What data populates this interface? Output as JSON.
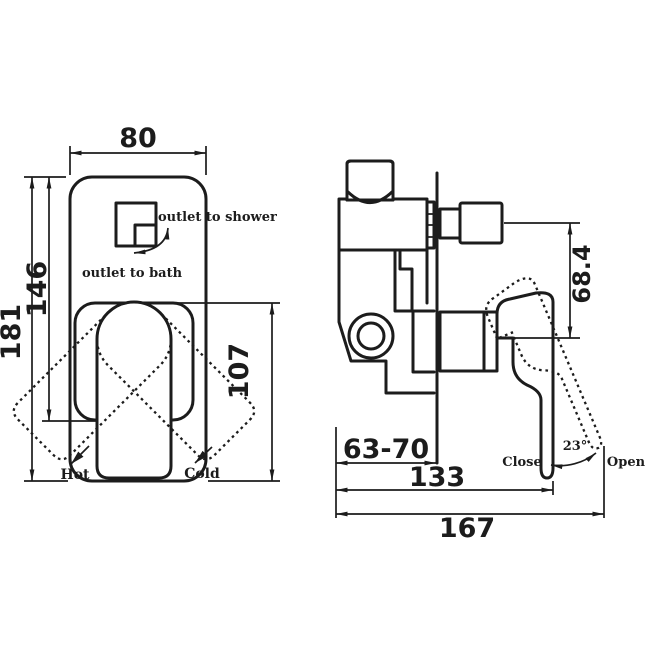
{
  "colors": {
    "line": "#1c1c1c",
    "background": "#ffffff"
  },
  "front_view": {
    "dim_width": "80",
    "dim_height": "181",
    "dim_outlet_drop": "146",
    "dim_handle_span": "107",
    "outlet_shower": "outlet to shower",
    "outlet_bath": "outlet to bath",
    "hot": "Hot",
    "cold": "Cold"
  },
  "side_view": {
    "dim_handle_offset": "68.4",
    "dim_wall_depth": "63-70",
    "dim_body_length": "133",
    "dim_overall_length": "167",
    "close": "Close",
    "angle": "23°",
    "open": "Open"
  }
}
